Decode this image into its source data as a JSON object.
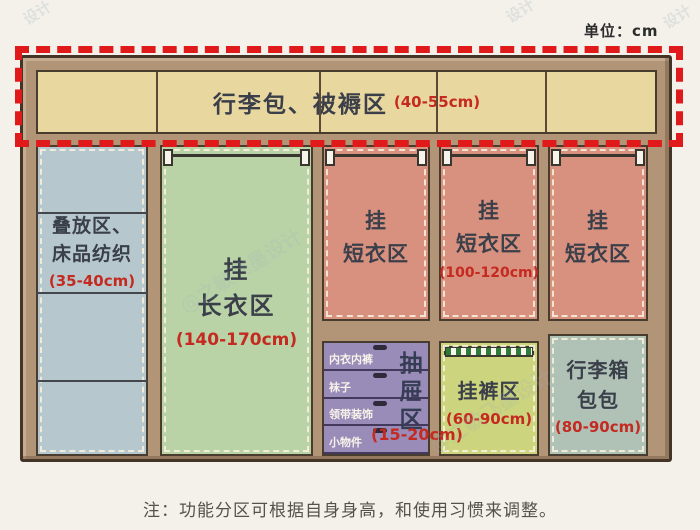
{
  "unit_label": "单位：cm",
  "note": "注：功能分区可根据自身身高，和使用习惯来调整。",
  "watermark": {
    "text": "@之敏飞墨设计",
    "fragment": "设计"
  },
  "colors": {
    "background": "#f4f1ea",
    "frame": "#b29476",
    "frame_outline": "#443428",
    "highlight_dash_red": "#e01a1a",
    "top_band": "#e9d7a0",
    "stack_zone": "#b6c8ce",
    "long_coat_zone": "#bad3a6",
    "short_coat_zone": "#d9917f",
    "drawer_zone": "#9a8cb8",
    "pants_zone": "#ccd47d",
    "luggage_bottom_zone": "#b0c2b6",
    "label_text": "#3a3f4a",
    "range_text": "#c42a20"
  },
  "zones": {
    "top": {
      "label": "行李包、被褥区",
      "range": "(40-55cm)"
    },
    "stack": {
      "line1": "叠放区、",
      "line2": "床品纺织",
      "range": "(35-40cm)"
    },
    "long_coat": {
      "line1": "挂",
      "line2": "长衣区",
      "range": "(140-170cm)"
    },
    "short_coat_1": {
      "line1": "挂",
      "line2": "短衣区"
    },
    "short_coat_2": {
      "line1": "挂",
      "line2": "短衣区",
      "range": "(100-120cm)"
    },
    "short_coat_3": {
      "line1": "挂",
      "line2": "短衣区"
    },
    "drawer": {
      "items": [
        "内衣内裤",
        "袜子",
        "领带装饰",
        "小物件"
      ],
      "label": "抽屉区",
      "range": "(15-20cm)"
    },
    "pants": {
      "label": "挂裤区",
      "range": "(60-90cm)"
    },
    "luggage_bottom": {
      "line1": "行李箱",
      "line2": "包包",
      "range": "(80-90cm)"
    }
  }
}
